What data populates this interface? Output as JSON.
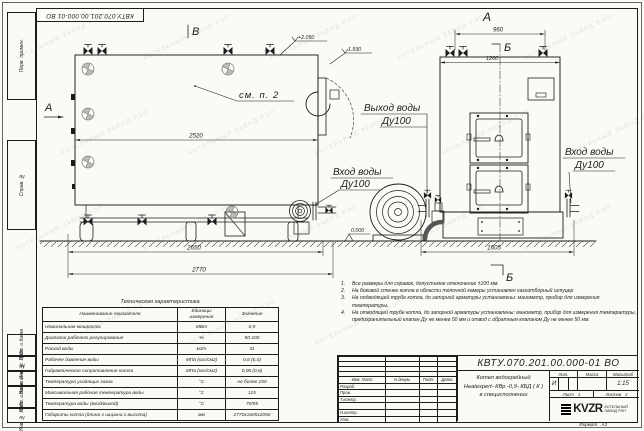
{
  "doc": {
    "number": "КВТУ.070.201.00.000-01 ВО"
  },
  "side_strip": {
    "labels": [
      "Перв. примен.",
      "Справ. №",
      "Подп. и дата",
      "Инв. № дубл.",
      "Взам. инв. №",
      "Подп. и дата",
      "Инв. № подл."
    ]
  },
  "drawing": {
    "view_b": "В",
    "view_a_arrow": "А",
    "view_a_top": "А",
    "section_b_top": "Б",
    "section_b_bottom": "Б",
    "see_note": "см. п. 2",
    "dims": {
      "d2520": "2520",
      "d2650": "2650",
      "d2770": "2770",
      "d960": "960",
      "d1260": "1260",
      "d1605": "1605"
    },
    "elevations": {
      "top": "+2.050",
      "mid": "1.930",
      "zero": "0.000"
    },
    "labels": {
      "outlet_title": "Выход воды",
      "outlet_dn": "Ду100",
      "inlet_title": "Вход воды",
      "inlet_dn": "Ду100",
      "inlet2_title": "Вход воды",
      "inlet2_dn": "Ду100"
    }
  },
  "spec": {
    "title": "Техническая характеристика",
    "headers": [
      "Наименование показателя",
      "Единицы измерения",
      "Значение"
    ],
    "rows": [
      [
        "Номинальная мощность",
        "МВт",
        "0,9"
      ],
      [
        "Диапазон рабочего регулирования",
        "%",
        "50-100"
      ],
      [
        "Расход воды",
        "м3/ч",
        "31"
      ],
      [
        "Рабочее давление воды",
        "МПа (кгс/см2)",
        "0,6 (6,0)"
      ],
      [
        "Гидравлическое сопротивление котла",
        "МПа (кгс/см2)",
        "0,06 (0,6)"
      ],
      [
        "Температура уходящих газов",
        "°С",
        "не более 250"
      ],
      [
        "Максимальная рабочая температура воды",
        "°С",
        "115"
      ],
      [
        "Температура воды (вход/выход)",
        "°С",
        "70/95"
      ],
      [
        "Габариты котла (длина х ширина х высота)",
        "мм",
        "2770х1605х2050"
      ]
    ]
  },
  "notes": [
    {
      "n": "1.",
      "text": "Все размеры для справок, допустимое отклонение ±100 мм."
    },
    {
      "n": "2.",
      "text": "На боковой стенке котла в области топочной камеры установлен газоотборный штуцер"
    },
    {
      "n": "3.",
      "text": "На подводящей трубе котла, до запорной арматуры установлены: манометр, прибор для измерения температуры."
    },
    {
      "n": "4.",
      "text": "На отводящей трубе котла, до запорной арматуры установлены: манометр, прибор для измерения температуры, предохранительный клапан Ду не менее 50 мм и отвод с обратным клапаном Ду не менее 50 мм."
    }
  ],
  "title_block": {
    "cols": [
      "Изм. Лист",
      "N докум.",
      "Подп.",
      "Дата"
    ],
    "row_labels": [
      "Разраб.",
      "Пров.",
      "Т.контр.",
      "",
      "Н.контр.",
      "Утв."
    ],
    "name_line1": "Котел водогрейный",
    "name_line2": "Heatexpert- КВр -0,9- КБД ( К )",
    "name_line3": "в специсполнении",
    "lit_label": "Лит.",
    "mass_label": "Масса",
    "scale_label": "Масштаб",
    "lit_value": "И",
    "scale_value": "1:15",
    "sheet_label": "Лист",
    "sheet_value": "1",
    "sheets_label": "Листов",
    "sheets_value": "2",
    "logo": "KVZR",
    "company_line1": "КОТЕЛЬНЫЙ",
    "company_line2": "ЗАВОД РЭП",
    "format_label": "Формат",
    "format_value": "А3"
  },
  "watermark": "КОТЕЛЬНЫЙ ЗАВОД РЭП"
}
